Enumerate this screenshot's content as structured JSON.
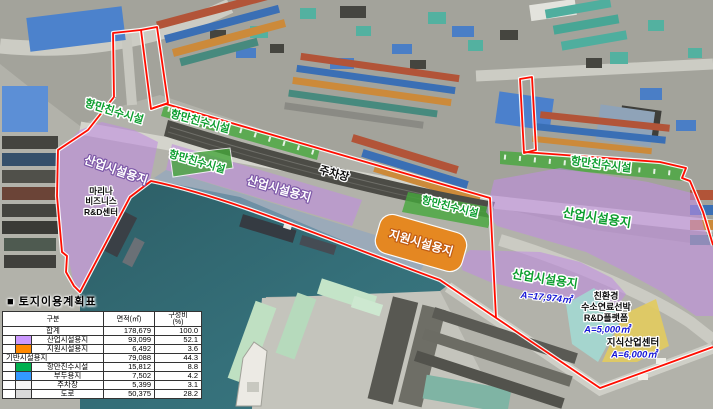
{
  "map": {
    "zone_labels": {
      "waterfront": "항만친수시설",
      "industrial": "산업시설용지",
      "support": "지원시설용지",
      "parking": "주차장"
    },
    "annotations": {
      "marina_line1": "마리나",
      "marina_line2": "비즈니스",
      "marina_line3": "R&D센터",
      "industrial_right_area": "A=17,974㎡",
      "eco_line1": "친환경",
      "eco_line2": "수소연료선박",
      "eco_line3": "R&D플랫폼",
      "eco_area": "A=5,000㎡",
      "knowledge_name": "지식산업센터",
      "knowledge_area": "A=6,000㎡"
    },
    "colors": {
      "industrial": "#CC99FF",
      "support": "#FF8800",
      "waterfront": "#00B050",
      "wharf": "#3399FF",
      "parking": "#F5F5F5",
      "road": "#D9D9D9",
      "boundary": "#FF0D00",
      "area_text": "#1616D6",
      "label_green": "#0C9E2E"
    }
  },
  "table": {
    "bullet": "■",
    "title": "토지이용계획표",
    "headers": {
      "category": "구분",
      "area": "면적(㎡)",
      "ratio_line1": "구성비",
      "ratio_line2": "(%)"
    },
    "rows": [
      {
        "label": "합계",
        "area": "178,679",
        "ratio": "100.0"
      },
      {
        "label": "산업시설용지",
        "area": "93,099",
        "ratio": "52.1",
        "swatch": "#CC99FF"
      },
      {
        "label": "지원시설용지",
        "area": "6,492",
        "ratio": "3.6",
        "swatch": "#FF8800"
      },
      {
        "label": "기반시설용지",
        "area": "79,088",
        "ratio": "44.3"
      },
      {
        "label": "항만친수시설",
        "area": "15,812",
        "ratio": "8.8",
        "swatch": "#00B050"
      },
      {
        "label": "부두용지",
        "area": "7,502",
        "ratio": "4.2",
        "swatch": "#3399FF"
      },
      {
        "label": "주차장",
        "area": "5,399",
        "ratio": "3.1",
        "swatch": "#F5F5F5"
      },
      {
        "label": "도로",
        "area": "50,375",
        "ratio": "28.2",
        "swatch": "#D9D9D9"
      }
    ]
  }
}
